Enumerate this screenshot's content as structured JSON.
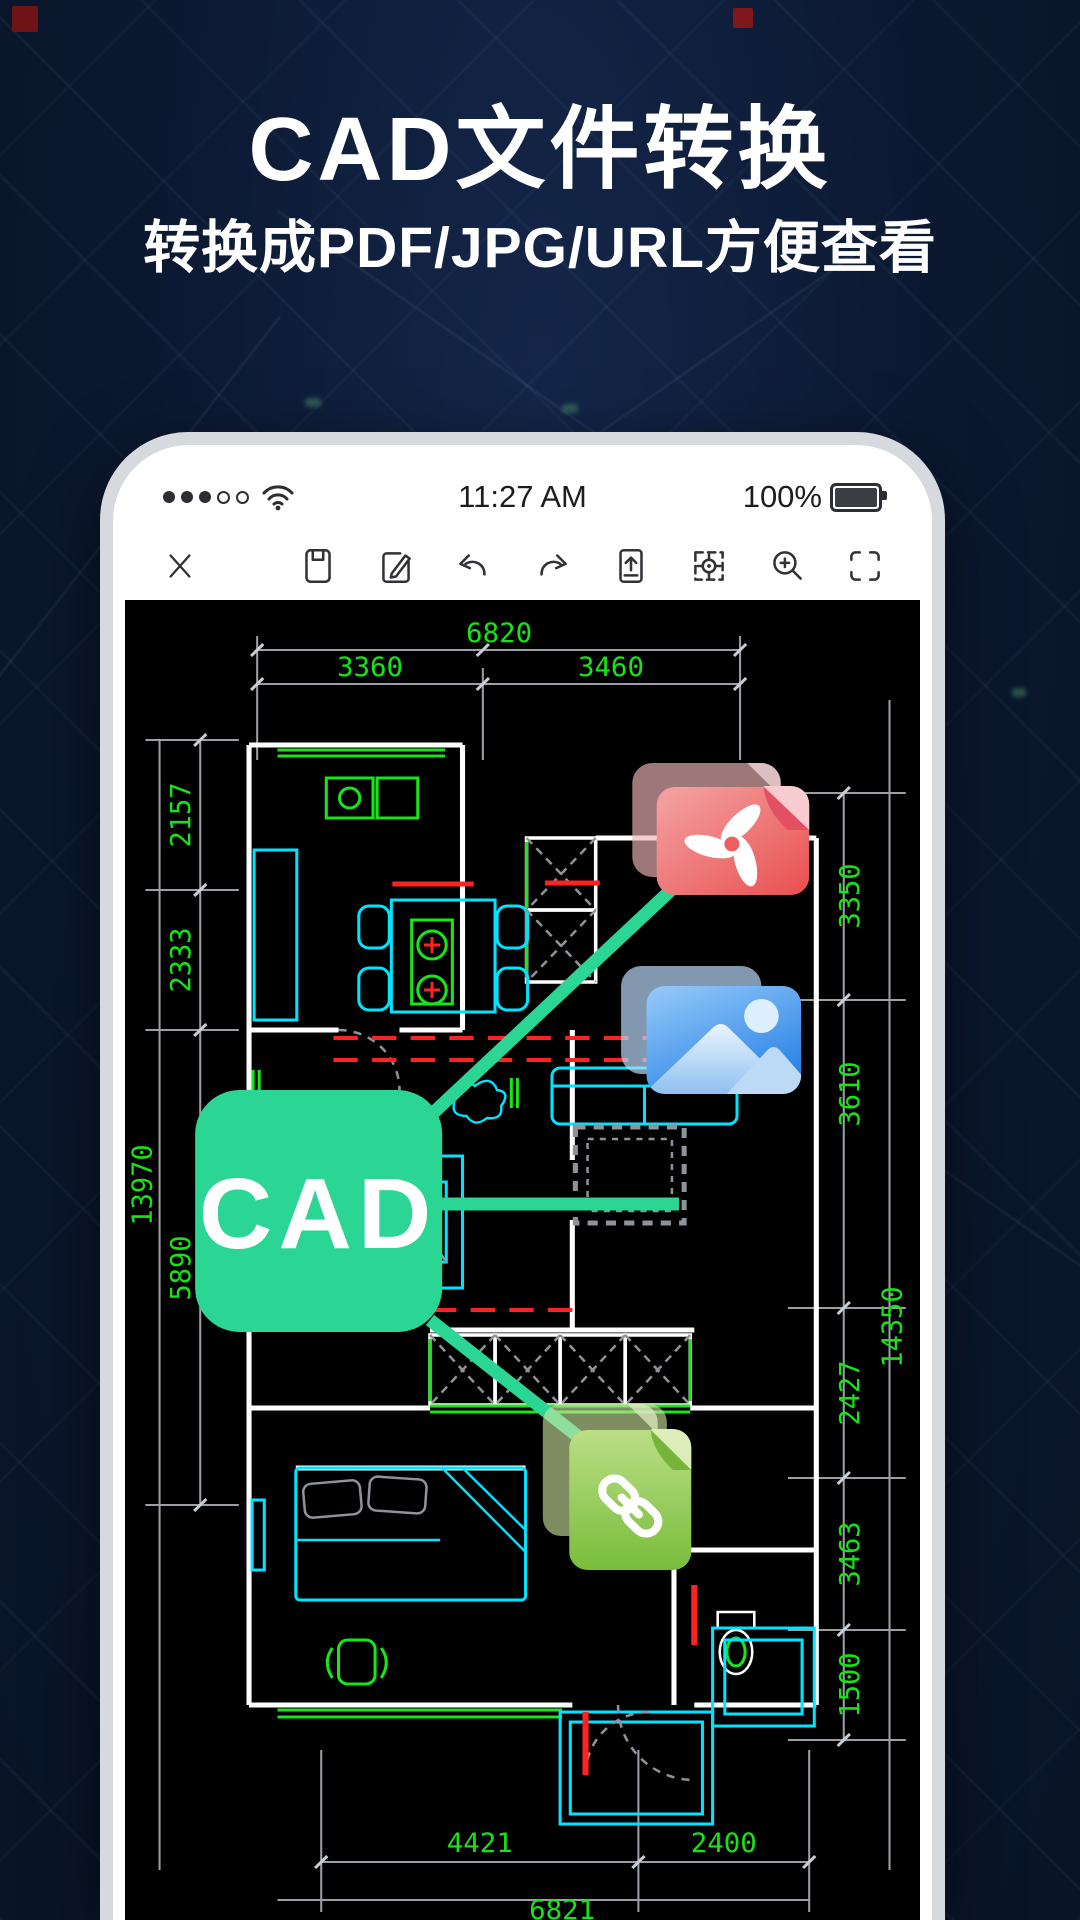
{
  "hero": {
    "title": "CAD文件转换",
    "subtitle": "转换成PDF/JPG/URL方便查看"
  },
  "statusbar": {
    "time": "11:27 AM",
    "battery_percent": "100%",
    "signal_filled_dots": 3,
    "signal_empty_dots": 2,
    "icons": [
      "cellular-signal-icon",
      "wifi-icon",
      "battery-icon"
    ]
  },
  "toolbar": {
    "icons": [
      "close-icon",
      "save-icon",
      "edit-icon",
      "undo-icon",
      "redo-icon",
      "upload-icon",
      "locate-icon",
      "zoom-in-icon",
      "fullscreen-icon"
    ]
  },
  "badge": {
    "label": "CAD"
  },
  "file_icons": [
    {
      "name": "pdf-file-icon",
      "format": "PDF"
    },
    {
      "name": "image-file-icon",
      "format": "JPG"
    },
    {
      "name": "link-file-icon",
      "format": "URL"
    }
  ],
  "floorplan": {
    "dims": {
      "top": [
        "6820",
        "3360",
        "3460"
      ],
      "left": [
        "2157",
        "2333",
        "5890",
        "13970"
      ],
      "right": [
        "3350",
        "3610",
        "2427",
        "3463",
        "1500",
        "14350"
      ],
      "bottom": [
        "4421",
        "2400",
        "6821"
      ]
    }
  },
  "colors": {
    "accent_mint": "#2bd593",
    "pdf_red": "#ec5d5d",
    "image_blue": "#3b8de8",
    "link_green": "#7fc242",
    "dim_green": "#17e317",
    "furniture_cyan": "#00e4ff",
    "alert_red": "#ff2222",
    "background_navy": "#0b1830"
  }
}
